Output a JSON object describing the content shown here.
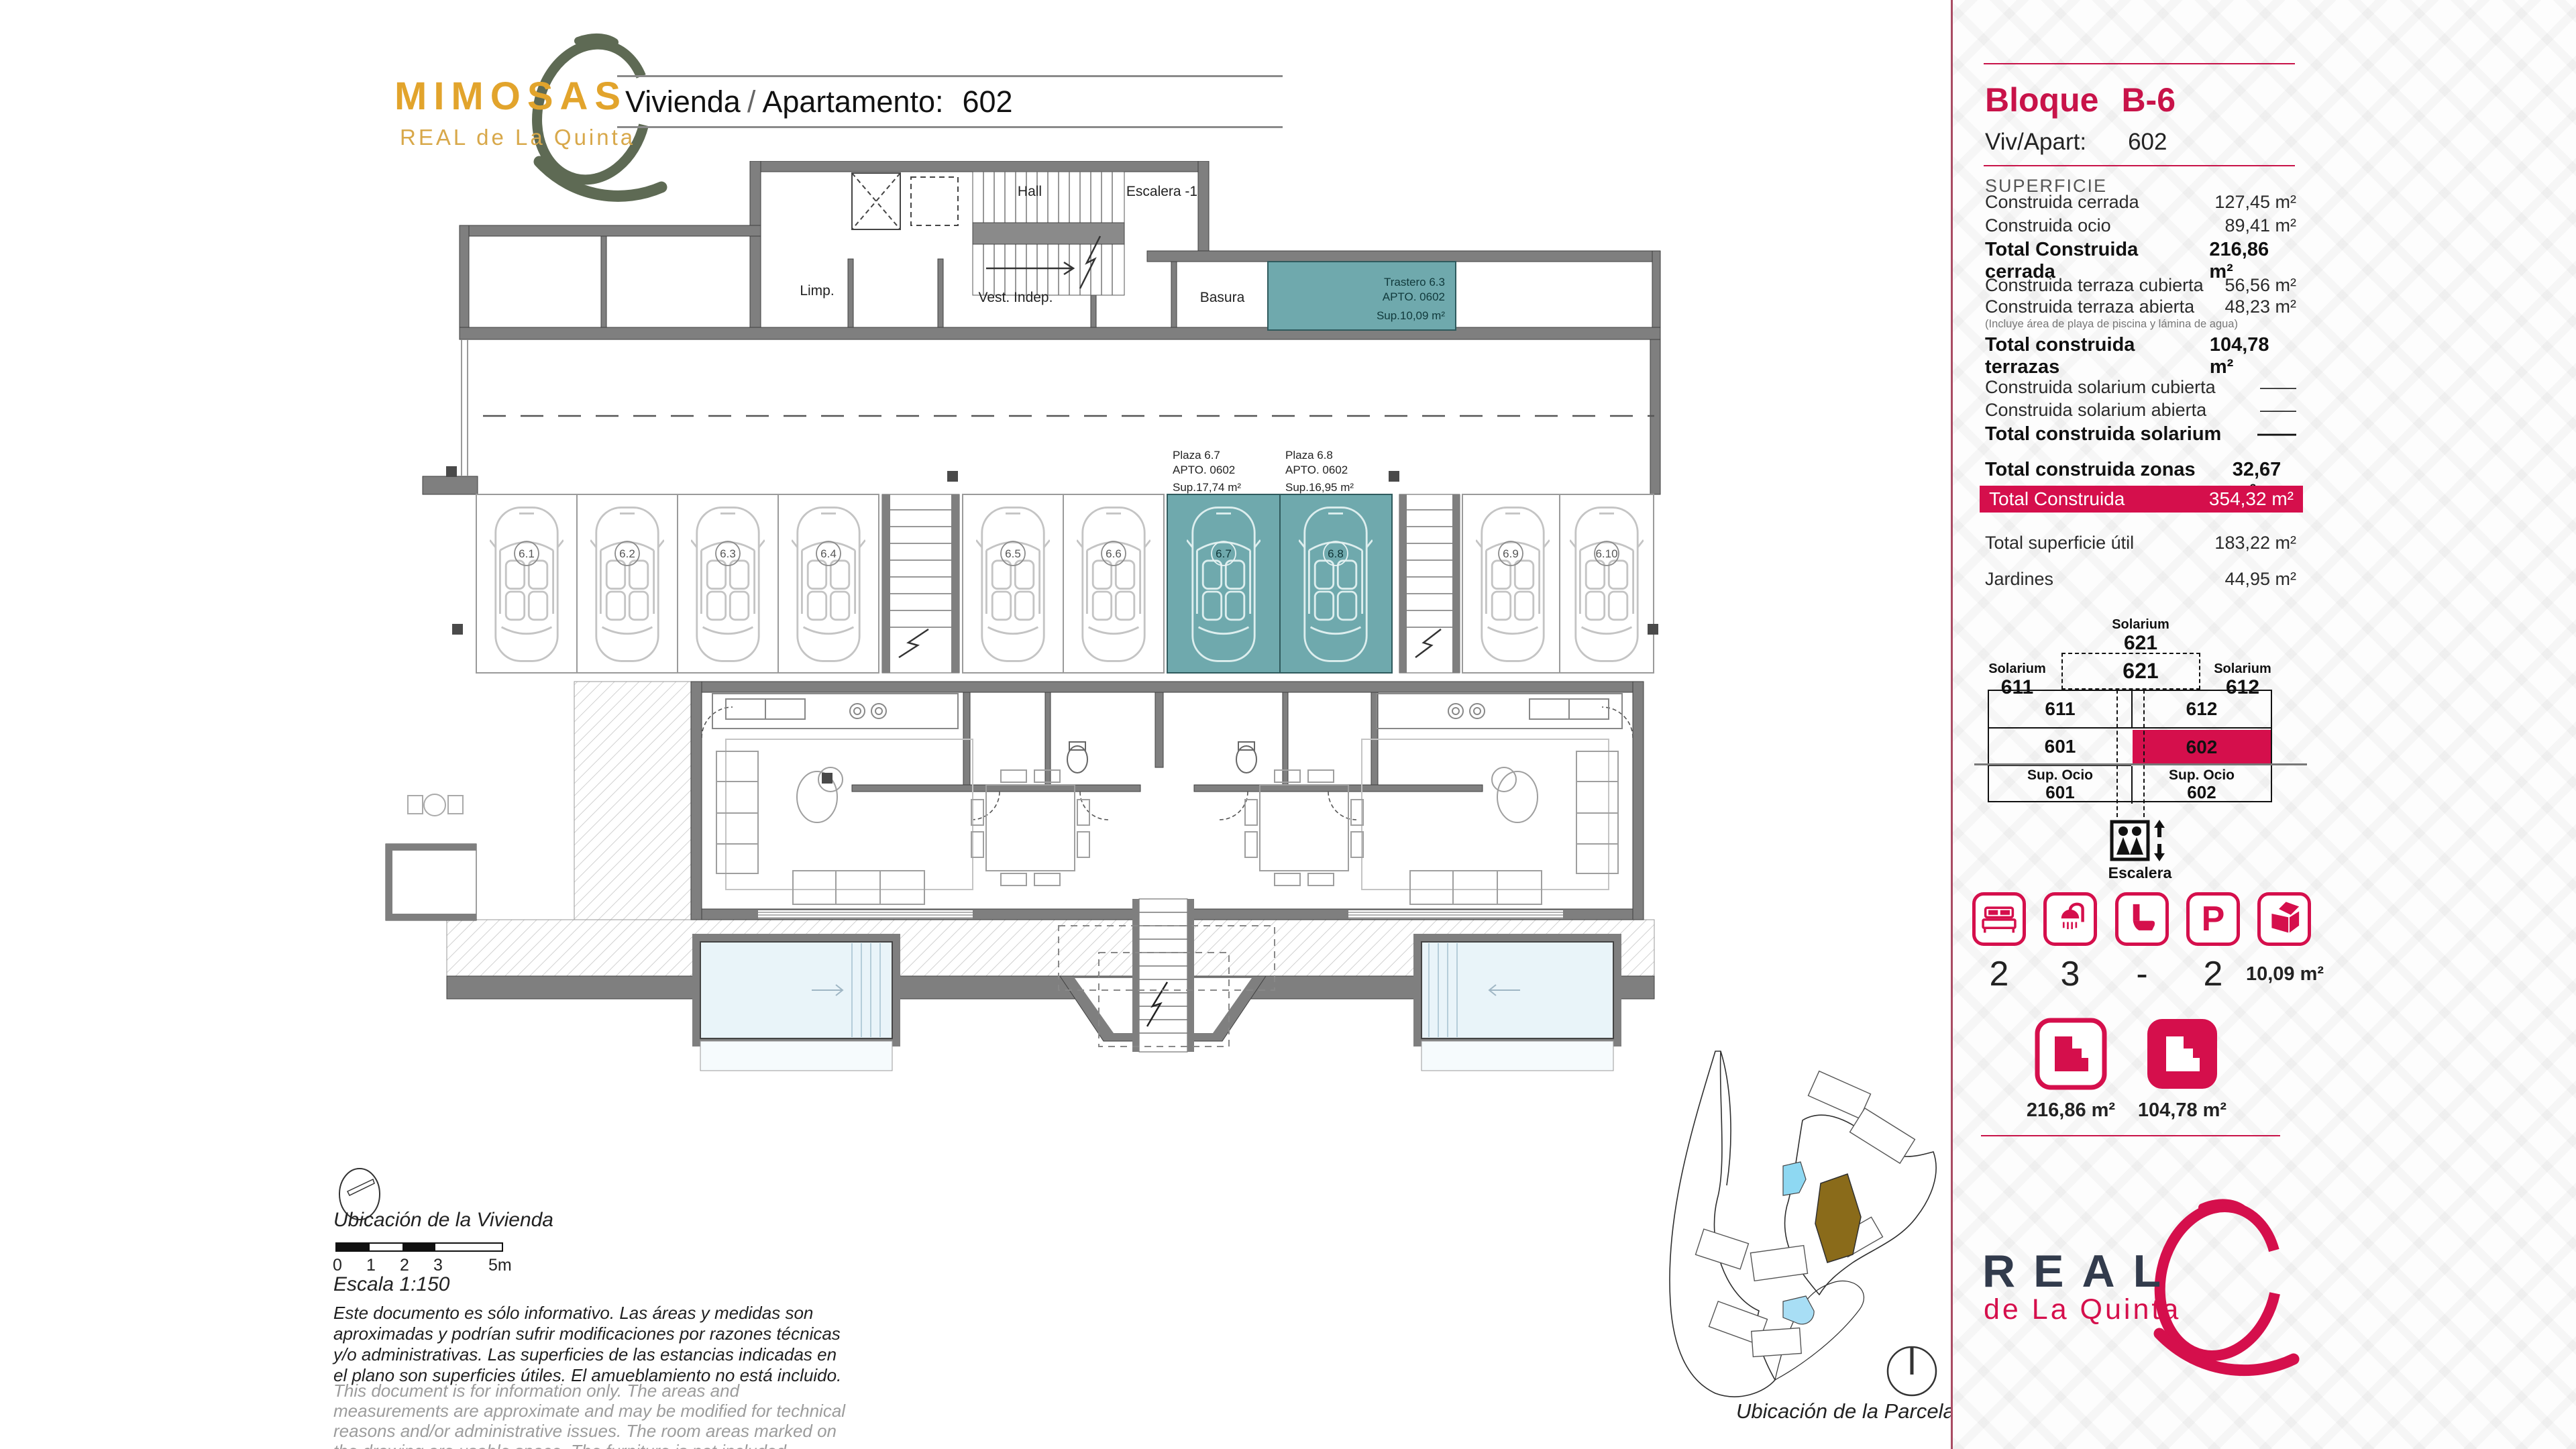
{
  "colors": {
    "accent": "#d50f4c",
    "accent_line": "#c81349",
    "teal": "#6fa9ad",
    "gold": "#e2a42c",
    "olive": "#5e6a54",
    "navy": "#323b4c",
    "wall": "#7f7f7f"
  },
  "header": {
    "brand": "MIMOSAS",
    "brand_sub": "REAL de La Quinta",
    "title_left": "Vivienda",
    "title_sep": "/",
    "title_mid": "Apartamento:",
    "title_value": "602"
  },
  "sidebar": {
    "block_label": "Bloque",
    "block_value": "B-6",
    "unit_label": "Viv/Apart:",
    "unit_value": "602",
    "superficie_heading": "SUPERFICIE",
    "rows": [
      {
        "label": "Construida cerrada",
        "value": "127,45 m²"
      },
      {
        "label": "Construida ocio",
        "value": "89,41 m²"
      },
      {
        "label": "Total Construida cerrada",
        "value": "216,86 m²"
      },
      {
        "label": "Construida terraza cubierta",
        "value": "56,56 m²"
      },
      {
        "label": "Construida terraza abierta",
        "value": "48,23 m²"
      },
      {
        "label": "Total construida terrazas",
        "value": "104,78 m²"
      },
      {
        "label": "Construida solarium cubierta",
        "value": "——"
      },
      {
        "label": "Construida solarium abierta",
        "value": "——"
      },
      {
        "label": "Total construida solarium",
        "value": "——"
      },
      {
        "label": "Total construida zonas comunes",
        "value": "32,67 m²"
      },
      {
        "label": "Total superficie útil",
        "value": "183,22 m²"
      },
      {
        "label": "Jardines",
        "value": "44,95 m²"
      }
    ],
    "note": "(Incluye área de playa de piscina y lámina de agua)",
    "total_label": "Total Construida",
    "total_value": "354,32 m²",
    "diagram": {
      "top_label": "Solarium",
      "top_num": "621",
      "box_num": "621",
      "left_label": "Solarium",
      "left_num": "611",
      "right_label": "Solarium",
      "right_num": "612",
      "r1l": "611",
      "r1r": "612",
      "r2l": "601",
      "r2r": "602",
      "r3l_label": "Sup. Ocio",
      "r3l_num": "601",
      "r3r_label": "Sup. Ocio",
      "r3r_num": "602",
      "stairs_label": "Escalera"
    },
    "amenities": {
      "bed": "2",
      "shower": "3",
      "toilet": "-",
      "parking": "2",
      "storage": "10,09 m²",
      "parking_letter": "P"
    },
    "floor_icons": [
      {
        "value": "216,86 m²"
      },
      {
        "value": "104,78 m²"
      }
    ],
    "brand": "REAL",
    "brand_sub": "de La Quinta"
  },
  "plan": {
    "rooms": {
      "hall": "Hall",
      "stairs": "Escalera -1",
      "limp": "Limp.",
      "vest": "Vest. Indep.",
      "basura": "Basura"
    },
    "trastero": {
      "l1": "Trastero 6.3",
      "l2": "APTO. 0602",
      "l3": "Sup.10,09 m²"
    },
    "plaza1": {
      "l1": "Plaza 6.7",
      "l2": "APTO. 0602",
      "l3": "Sup.17,74 m²"
    },
    "plaza2": {
      "l1": "Plaza 6.8",
      "l2": "APTO. 0602",
      "l3": "Sup.16,95 m²"
    },
    "spaces": [
      "6.1",
      "6.2",
      "6.3",
      "6.4",
      "6.5",
      "6.6",
      "6.7",
      "6.8",
      "6.9",
      "6.10"
    ]
  },
  "footer": {
    "location_home": "Ubicación de la Vivienda",
    "scale_text": "Escala 1:150",
    "ticks": [
      "0",
      "1",
      "2",
      "3",
      "5m"
    ],
    "note_es": "Este documento es sólo informativo. Las áreas y medidas son aproximadas y podrían sufrir modificaciones por razones técnicas y/o administrativas. Las superficies de las estancias indicadas en el plano son superficies útiles. El amueblamiento no está incluido.",
    "note_en": "This document is for information only. The areas and measurements are approximate and may be modified for technical reasons and/or administrative issues. The room areas marked on the drawing are usable space. The furniture is not included.",
    "location_parcel": "Ubicación de la Parcela"
  }
}
